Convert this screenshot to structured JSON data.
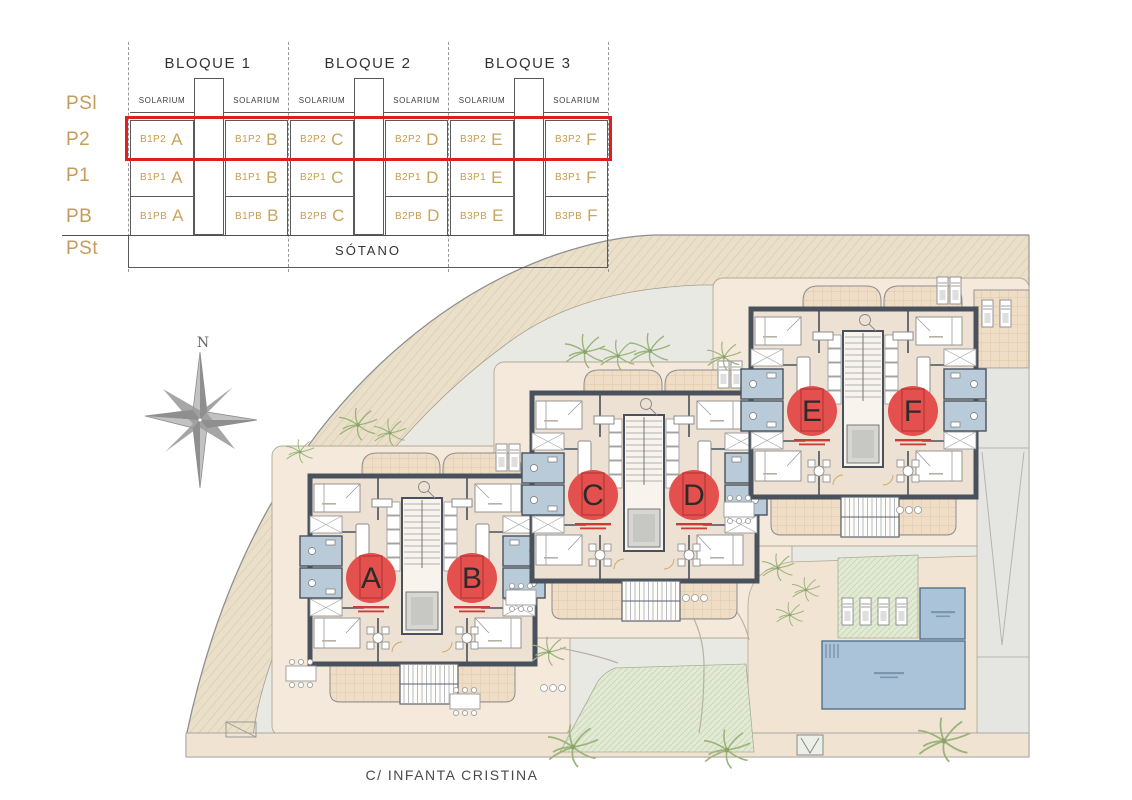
{
  "selector": {
    "floor_labels": [
      "PSl",
      "P2",
      "P1",
      "PB",
      "PSt"
    ],
    "block_labels": [
      "BLOQUE 1",
      "BLOQUE 2",
      "BLOQUE 3"
    ],
    "solarium_label": "SOLARIUM",
    "sotano_label": "SÓTANO",
    "highlighted_floor": "P2",
    "rows": {
      "p2": [
        {
          "code": "B1P2",
          "letter": "A"
        },
        {
          "code": "B1P2",
          "letter": "B"
        },
        {
          "code": "B2P2",
          "letter": "C"
        },
        {
          "code": "B2P2",
          "letter": "D"
        },
        {
          "code": "B3P2",
          "letter": "E"
        },
        {
          "code": "B3P2",
          "letter": "F"
        }
      ],
      "p1": [
        {
          "code": "B1P1",
          "letter": "A"
        },
        {
          "code": "B1P1",
          "letter": "B"
        },
        {
          "code": "B2P1",
          "letter": "C"
        },
        {
          "code": "B2P1",
          "letter": "D"
        },
        {
          "code": "B3P1",
          "letter": "E"
        },
        {
          "code": "B3P1",
          "letter": "F"
        }
      ],
      "pb": [
        {
          "code": "B1PB",
          "letter": "A"
        },
        {
          "code": "B1PB",
          "letter": "B"
        },
        {
          "code": "B2PB",
          "letter": "C"
        },
        {
          "code": "B2PB",
          "letter": "D"
        },
        {
          "code": "B3PB",
          "letter": "E"
        },
        {
          "code": "B3PB",
          "letter": "F"
        }
      ]
    }
  },
  "plan": {
    "compass_label": "N",
    "street_label": "C/ INFANTA CRISTINA",
    "unit_markers": [
      {
        "letter": "A"
      },
      {
        "letter": "B"
      },
      {
        "letter": "C"
      },
      {
        "letter": "D"
      },
      {
        "letter": "E"
      },
      {
        "letter": "F"
      }
    ]
  },
  "colors": {
    "highlight_red": "#df1f1f",
    "marker_red": "#e4504e",
    "accent_tan": "#c59b59",
    "wall_dark": "#49525c",
    "pool_blue": "#abc3d8",
    "lawn_green": "#e2ead4",
    "paving_pink": "#f2e4d3"
  }
}
